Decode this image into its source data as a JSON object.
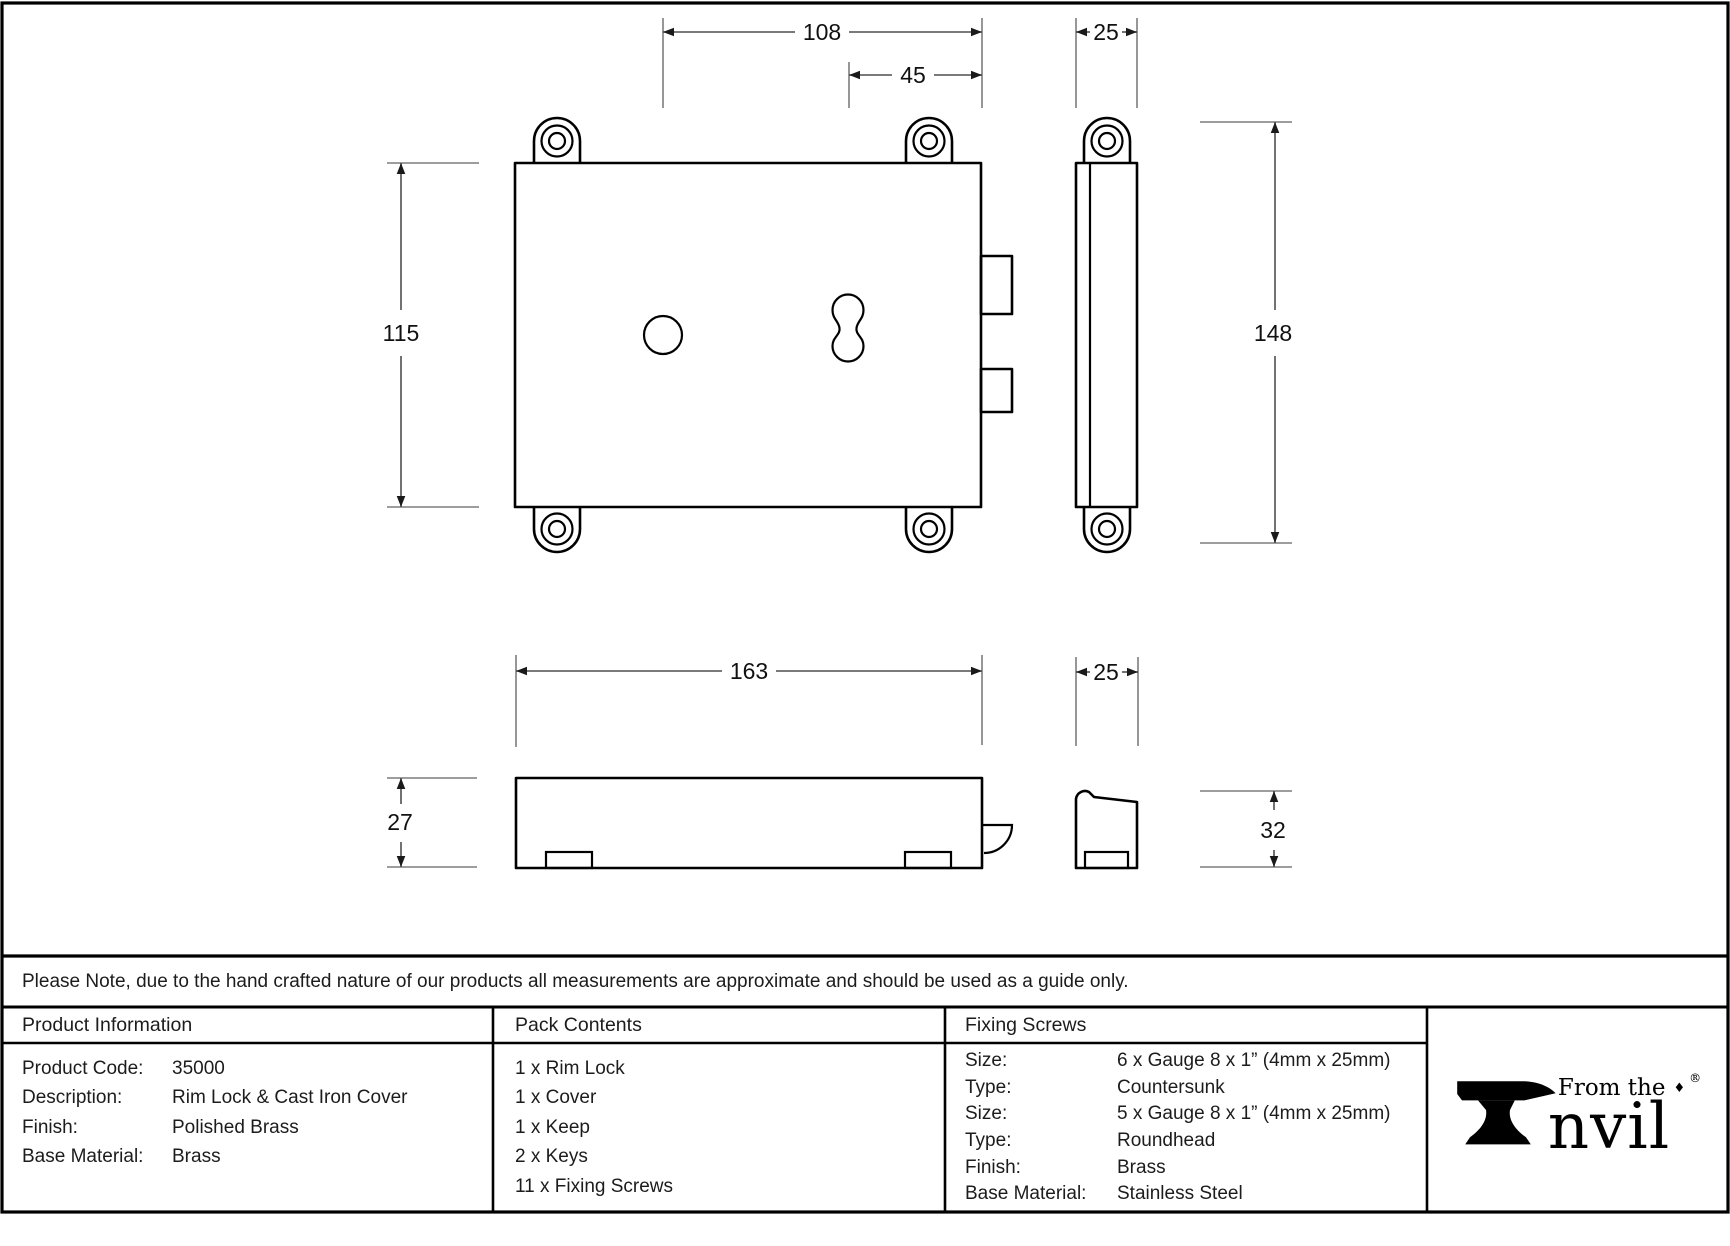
{
  "dims": {
    "d108": "108",
    "d45": "45",
    "d25_top": "25",
    "d115": "115",
    "d148": "148",
    "d163": "163",
    "d25_bottom": "25",
    "d27": "27",
    "d32": "32"
  },
  "note": {
    "text": "Please Note, due to the hand crafted nature of our products all measurements are approximate and should be used as a guide only."
  },
  "product_information": {
    "header": "Product Information",
    "rows": [
      {
        "label": "Product Code:",
        "value": "35000"
      },
      {
        "label": "Description:",
        "value": "Rim Lock & Cast Iron Cover"
      },
      {
        "label": "Finish:",
        "value": "Polished Brass"
      },
      {
        "label": "Base Material:",
        "value": "Brass"
      }
    ]
  },
  "pack_contents": {
    "header": "Pack Contents",
    "items": [
      "1 x Rim Lock",
      "1 x Cover",
      "1 x Keep",
      "2 x Keys",
      "11 x Fixing Screws"
    ]
  },
  "fixing_screws": {
    "header": "Fixing Screws",
    "rows": [
      {
        "label": "Size:",
        "value": "6 x Gauge 8 x 1” (4mm x 25mm)"
      },
      {
        "label": "Type:",
        "value": "Countersunk"
      },
      {
        "label": "Size:",
        "value": "5 x Gauge 8 x 1” (4mm x 25mm)"
      },
      {
        "label": "Type:",
        "value": "Roundhead"
      },
      {
        "label": "Finish:",
        "value": "Brass"
      },
      {
        "label": "Base Material:",
        "value": "Stainless Steel"
      }
    ]
  },
  "logo": {
    "from_the": "From the",
    "diamond": "♦",
    "registered": "®",
    "brand_rest": "nvil"
  },
  "colors": {
    "line": "#000000",
    "dim_line": "#4f4f4f",
    "extension_line": "#7d7d7d",
    "background": "#ffffff"
  }
}
